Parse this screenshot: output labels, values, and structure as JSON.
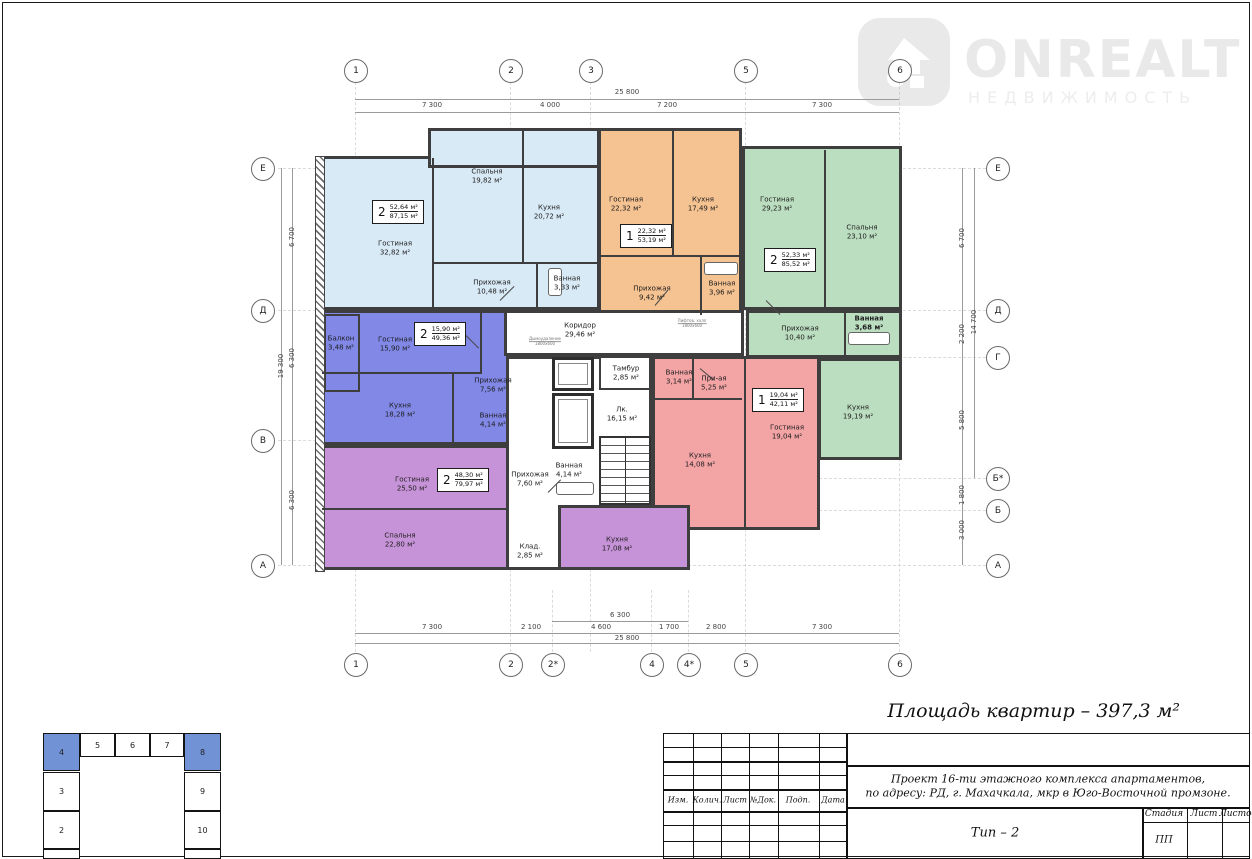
{
  "logo": {
    "brand": "ONREALT",
    "subtitle": "НЕДВИЖИМОСТЬ",
    "color": "#e9e9e9"
  },
  "summary": {
    "text": "Площадь квартир – 397,3 м²"
  },
  "axes": {
    "top": [
      "1",
      "2",
      "3",
      "5",
      "6"
    ],
    "bottom": [
      "1",
      "2",
      "2*",
      "4",
      "4*",
      "5",
      "6"
    ],
    "left": [
      "Е",
      "Д",
      "В",
      "А"
    ],
    "right": [
      "Е",
      "Д",
      "Г",
      "Б*",
      "Б",
      "А"
    ]
  },
  "dims": {
    "top_total": "25 800",
    "top_segments": [
      "7 300",
      "4 000",
      "7 200",
      "7 300"
    ],
    "bottom_span": "6 300",
    "bottom_segments": [
      "7 300",
      "2 100",
      "4 600",
      "1 700",
      "2 800",
      "7 300"
    ],
    "bottom_total": "25 800",
    "left_segments": [
      "6 700",
      "6 300",
      "6 300"
    ],
    "left_total": "19 300",
    "right_segments": [
      "6 700",
      "2 200",
      "5 800",
      "1 800",
      "3 000"
    ],
    "right_total": "14 700"
  },
  "apartments": [
    {
      "name": "light-blue",
      "color": "#d9eaf7",
      "stamp": {
        "rooms": "2",
        "living": "52,64 м²",
        "total": "87,15 м²"
      },
      "rooms": [
        {
          "name": "Гостиная",
          "area": "32,82 м²"
        },
        {
          "name": "Спальня",
          "area": "19,82 м²"
        },
        {
          "name": "Кухня",
          "area": "20,72 м²"
        },
        {
          "name": "Прихожая",
          "area": "10,48 м²"
        },
        {
          "name": "Ванная",
          "area": "3,33 м²"
        }
      ]
    },
    {
      "name": "orange",
      "color": "#f5c291",
      "stamp": {
        "rooms": "1",
        "living": "22,32 м²",
        "total": "53,19 м²"
      },
      "rooms": [
        {
          "name": "Гостиная",
          "area": "22,32 м²"
        },
        {
          "name": "Кухня",
          "area": "17,49 м²"
        },
        {
          "name": "Прихожая",
          "area": "9,42 м²"
        },
        {
          "name": "Ванная",
          "area": "3,96 м²"
        }
      ]
    },
    {
      "name": "green",
      "color": "#bcdec0",
      "stamp": {
        "rooms": "2",
        "living": "52,33 м²",
        "total": "85,52 м²"
      },
      "rooms": [
        {
          "name": "Гостиная",
          "area": "29,23 м²"
        },
        {
          "name": "Спальня",
          "area": "23,10 м²"
        },
        {
          "name": "Прихожая",
          "area": "10,40 м²"
        },
        {
          "name": "Ванная",
          "area": "3,68 м²"
        },
        {
          "name": "Кухня",
          "area": "19,19 м²"
        }
      ]
    },
    {
      "name": "indigo",
      "color": "#8188e6",
      "stamp": {
        "rooms": "2",
        "living": "15,90 м²",
        "total": "49,36 м²"
      },
      "rooms": [
        {
          "name": "Балкон",
          "area": "3,48 м²"
        },
        {
          "name": "Гостиная",
          "area": "15,90 м²"
        },
        {
          "name": "Кухня",
          "area": "18,28 м²"
        },
        {
          "name": "Прихожая",
          "area": "7,56 м²"
        },
        {
          "name": "Ванная",
          "area": "4,14 м²"
        }
      ]
    },
    {
      "name": "pink",
      "color": "#f3a4a5",
      "stamp": {
        "rooms": "1",
        "living": "19,04 м²",
        "total": "42,11 м²"
      },
      "rooms": [
        {
          "name": "Ванная",
          "area": "3,14 м²"
        },
        {
          "name": "При-ая",
          "area": "5,25 м²"
        },
        {
          "name": "Кухня",
          "area": "14,08 м²"
        },
        {
          "name": "Гостиная",
          "area": "19,04 м²"
        }
      ]
    },
    {
      "name": "purple",
      "color": "#c793d8",
      "stamp": {
        "rooms": "2",
        "living": "48,30 м²",
        "total": "79,97 м²"
      },
      "rooms": [
        {
          "name": "Гостиная",
          "area": "25,50 м²"
        },
        {
          "name": "Спальня",
          "area": "22,80 м²"
        },
        {
          "name": "Прихожая",
          "area": "7,60 м²"
        },
        {
          "name": "Ванная",
          "area": "4,14 м²"
        },
        {
          "name": "Клад.",
          "area": "2,85 м²"
        },
        {
          "name": "Кухня",
          "area": "17,08 м²"
        }
      ]
    }
  ],
  "common": {
    "corridor": {
      "name": "Коридор",
      "area": "29,46 м²"
    },
    "tambour": {
      "name": "Тамбур",
      "area": "2,85 м²"
    },
    "stair": {
      "name": "Лк.",
      "area": "16,15 м²"
    },
    "duct_left": {
      "line1": "Дымоудаление",
      "line2": "1800х600"
    },
    "duct_right": {
      "line1": "Лифтов. холл",
      "line2": "1800х600"
    }
  },
  "key_plan": {
    "top": [
      "4",
      "5",
      "6",
      "7",
      "8"
    ],
    "left": [
      "3",
      "2"
    ],
    "right": [
      "9",
      "10"
    ],
    "highlight": [
      "4",
      "8"
    ],
    "highlight_color": "#7193d6"
  },
  "title_block": {
    "cols": [
      "Изм.",
      "Колич.",
      "Лист",
      "№Док.",
      "Подп.",
      "Дата"
    ],
    "project_line1": "Проект 16-ти этажного комплекса апартаментов,",
    "project_line2": "по адресу: РД, г. Махачкала, мкр в Юго-Восточной промзоне.",
    "type_label": "Тип – 2",
    "stage_col": "Стадия",
    "sheet_col": "Лист",
    "sheets_col": "Листов",
    "stage_value": "ПП"
  }
}
